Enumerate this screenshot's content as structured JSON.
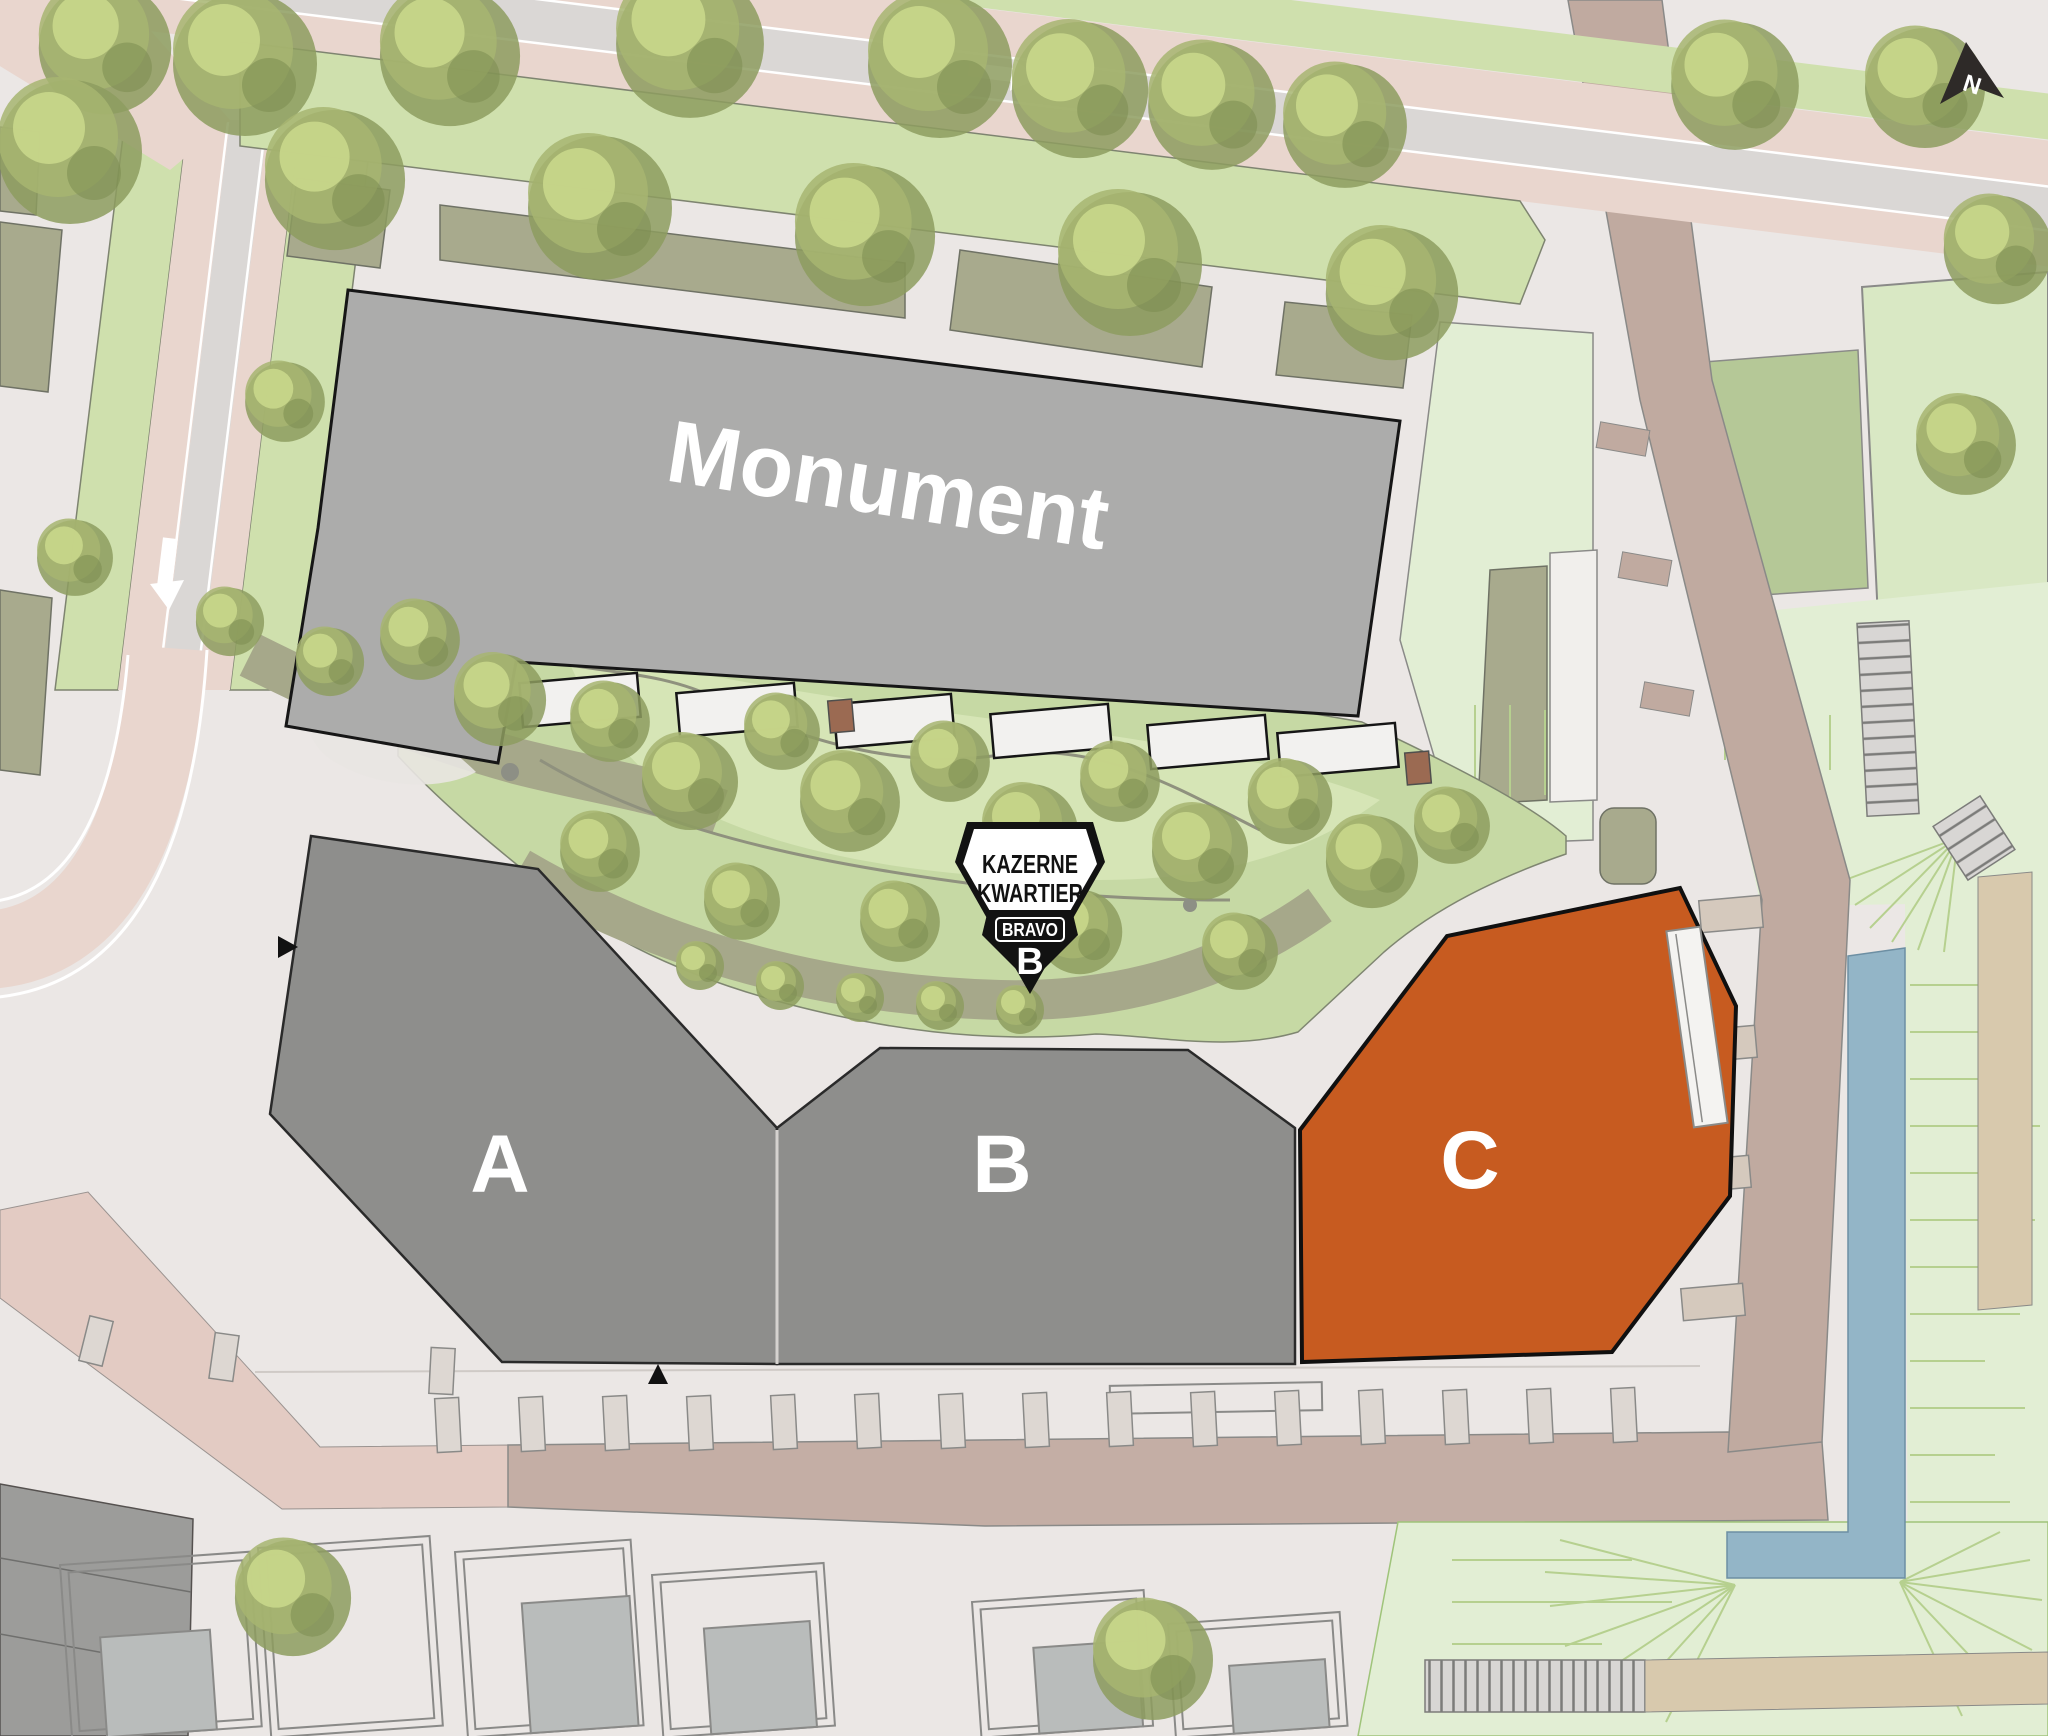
{
  "map_labels": {
    "monument": "Monument"
  },
  "blocks": [
    {
      "label": "A",
      "state": "default"
    },
    {
      "label": "B",
      "state": "default"
    },
    {
      "label": "C",
      "state": "highlighted"
    }
  ],
  "logo": {
    "top": "KAZERNE",
    "middle": "KWARTIER",
    "banner": "BRAVO",
    "monogram": "B"
  },
  "compass": {
    "north": "N"
  },
  "colors": {
    "monument": "#acacab",
    "block": "#8e8e8c",
    "block_active": "#c75b20",
    "water": "#93b5c7",
    "road_pink": "#e9d6ce",
    "road_gray": "#dad7d5",
    "road_taupe": "#c0aaa0",
    "verge_green": "#cfe0ad",
    "lawn": "#e2eed4",
    "garden": "#c6d9a4"
  }
}
